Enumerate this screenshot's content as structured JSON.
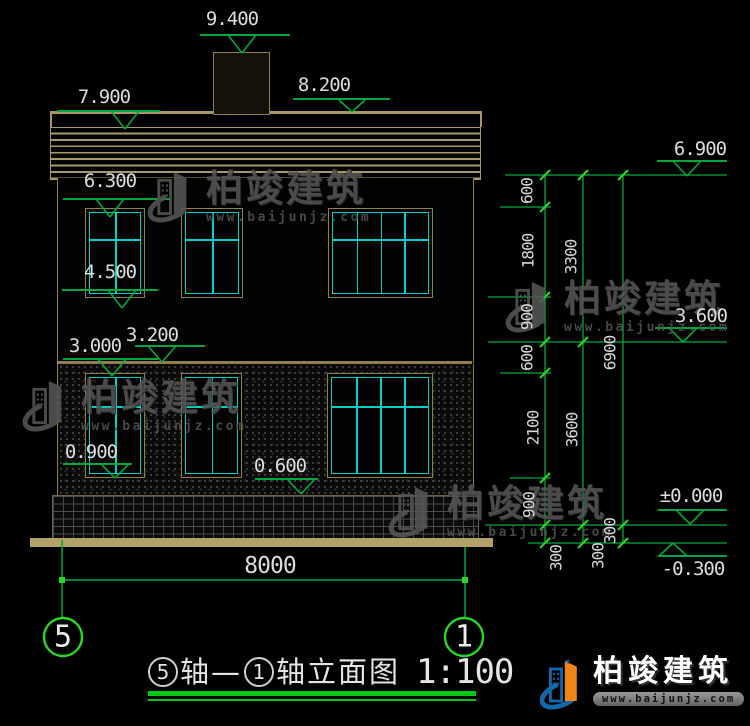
{
  "colors": {
    "dim_green": "#00a83c",
    "bright_green": "#2bd62b",
    "underline_green": "#00c814",
    "roof_tan": "#a89868",
    "frame_tan": "#8f7f4e",
    "ground_tan": "#b3a169",
    "window_cyan": "#00d2c8",
    "text_white": "#dcdcdc",
    "watermark_gray": "#565656",
    "logo_blue": "#1567ac",
    "logo_orange": "#ef8418"
  },
  "brand": {
    "name": "柏竣建筑",
    "url": "www.baijunjz.com"
  },
  "title": {
    "axis_from": "5",
    "axis_sep": "轴—",
    "axis_to": "1",
    "suffix": "轴立面图",
    "scale": "1:100"
  },
  "levels": {
    "left": [
      {
        "value": "9.400",
        "tx": 232,
        "ty": 8,
        "bx1": 200,
        "bx2": 290,
        "by": 35,
        "tcx": 242,
        "apex": 53
      },
      {
        "value": "8.200",
        "tx": 324,
        "ty": 74,
        "bx1": 293,
        "bx2": 390,
        "by": 99,
        "tcx": 352,
        "apex": 112
      },
      {
        "value": "7.900",
        "tx": 104,
        "ty": 86,
        "bx1": 57,
        "bx2": 160,
        "by": 111,
        "tcx": 125,
        "apex": 129
      },
      {
        "value": "6.300",
        "tx": 110,
        "ty": 170,
        "bx1": 63,
        "bx2": 170,
        "by": 199,
        "tcx": 110,
        "apex": 217
      },
      {
        "value": "4.500",
        "tx": 110,
        "ty": 261,
        "bx1": 62,
        "bx2": 158,
        "by": 290,
        "tcx": 122,
        "apex": 308
      },
      {
        "value": "3.200",
        "tx": 152,
        "ty": 324,
        "bx1": 135,
        "bx2": 205,
        "by": 346,
        "tcx": 162,
        "apex": 362
      },
      {
        "value": "3.000",
        "tx": 95,
        "ty": 335,
        "bx1": 63,
        "bx2": 158,
        "by": 359,
        "tcx": 112,
        "apex": 376
      },
      {
        "value": "0.900",
        "tx": 91,
        "ty": 441,
        "bx1": 63,
        "bx2": 132,
        "by": 464,
        "tcx": 115,
        "apex": 478
      },
      {
        "value": "0.600",
        "tx": 280,
        "ty": 455,
        "bx1": 255,
        "bx2": 318,
        "by": 479,
        "tcx": 301,
        "apex": 494
      }
    ],
    "right": [
      {
        "value": "6.900",
        "tx": 700,
        "ty": 138,
        "bx1": 657,
        "bx2": 727,
        "by": 161,
        "tcx": 687,
        "apex": 176
      },
      {
        "value": "3.600",
        "tx": 701,
        "ty": 305,
        "bx1": 655,
        "bx2": 727,
        "by": 328,
        "tcx": 683,
        "apex": 342
      },
      {
        "value": "±0.000",
        "tx": 691,
        "ty": 485,
        "bx1": 658,
        "bx2": 727,
        "by": 510,
        "tcx": 690,
        "apex": 524
      },
      {
        "value": "-0.300",
        "tx": 693,
        "ty": 558,
        "bx1": 658,
        "bx2": 727,
        "by": 556,
        "tcx": 673,
        "apex": 543
      }
    ]
  },
  "chains": {
    "vlines": [
      [
        545,
        175,
        543
      ],
      [
        583,
        175,
        543
      ],
      [
        623,
        175,
        543
      ]
    ],
    "ext_lines": [
      [
        505,
        727,
        175
      ],
      [
        500,
        551,
        207
      ],
      [
        488,
        551,
        297
      ],
      [
        488,
        727,
        342
      ],
      [
        500,
        551,
        373
      ],
      [
        510,
        551,
        478
      ],
      [
        485,
        727,
        525
      ],
      [
        528,
        727,
        543
      ]
    ],
    "ticks": [
      [
        545,
        175
      ],
      [
        545,
        207
      ],
      [
        545,
        297
      ],
      [
        545,
        342
      ],
      [
        545,
        373
      ],
      [
        545,
        478
      ],
      [
        545,
        525
      ],
      [
        545,
        543
      ],
      [
        583,
        175
      ],
      [
        583,
        342
      ],
      [
        583,
        525
      ],
      [
        583,
        543
      ],
      [
        623,
        175
      ],
      [
        623,
        525
      ],
      [
        623,
        543
      ]
    ],
    "labels": [
      {
        "t": "600",
        "x": 527,
        "y": 191
      },
      {
        "t": "1800",
        "x": 528,
        "y": 251
      },
      {
        "t": "900",
        "x": 527,
        "y": 317
      },
      {
        "t": "600",
        "x": 527,
        "y": 358
      },
      {
        "t": "2100",
        "x": 533,
        "y": 428
      },
      {
        "t": "900",
        "x": 529,
        "y": 505
      },
      {
        "t": "300",
        "x": 556,
        "y": 558
      },
      {
        "t": "3300",
        "x": 571,
        "y": 257
      },
      {
        "t": "3600",
        "x": 572,
        "y": 430
      },
      {
        "t": "300",
        "x": 598,
        "y": 556
      },
      {
        "t": "6900",
        "x": 610,
        "y": 353
      },
      {
        "t": "300",
        "x": 610,
        "y": 531
      }
    ]
  },
  "bottom_dim": {
    "value": "8000",
    "tx": 270,
    "ty": 553,
    "line": {
      "x1": 62,
      "x2": 465,
      "y": 580
    },
    "dots": [
      [
        62,
        580
      ],
      [
        465,
        580
      ]
    ],
    "ext_verticals": [
      [
        62,
        540,
        617
      ],
      [
        465,
        547,
        617
      ]
    ],
    "axis_bubbles": [
      {
        "label": "5",
        "cx": 63,
        "cy": 637,
        "r": 19
      },
      {
        "label": "1",
        "cx": 464,
        "cy": 637,
        "r": 19
      }
    ]
  },
  "windows": [
    {
      "x": 85,
      "y": 208,
      "w": 60,
      "h": 90,
      "cols": 2,
      "hbar": 30
    },
    {
      "x": 181,
      "y": 208,
      "w": 62,
      "h": 90,
      "cols": 2,
      "hbar": 30
    },
    {
      "x": 328,
      "y": 208,
      "w": 105,
      "h": 90,
      "cols": 4,
      "hbar": 30
    },
    {
      "x": 85,
      "y": 373,
      "w": 60,
      "h": 105,
      "cols": 2,
      "hbar": 32
    },
    {
      "x": 181,
      "y": 373,
      "w": 61,
      "h": 105,
      "cols": 2,
      "hbar": 32
    },
    {
      "x": 327,
      "y": 373,
      "w": 106,
      "h": 105,
      "cols": 4,
      "hbar": 32
    }
  ],
  "watermarks": {
    "positions": [
      [
        147,
        167
      ],
      [
        505,
        277
      ],
      [
        22,
        376
      ],
      [
        388,
        482
      ]
    ]
  }
}
